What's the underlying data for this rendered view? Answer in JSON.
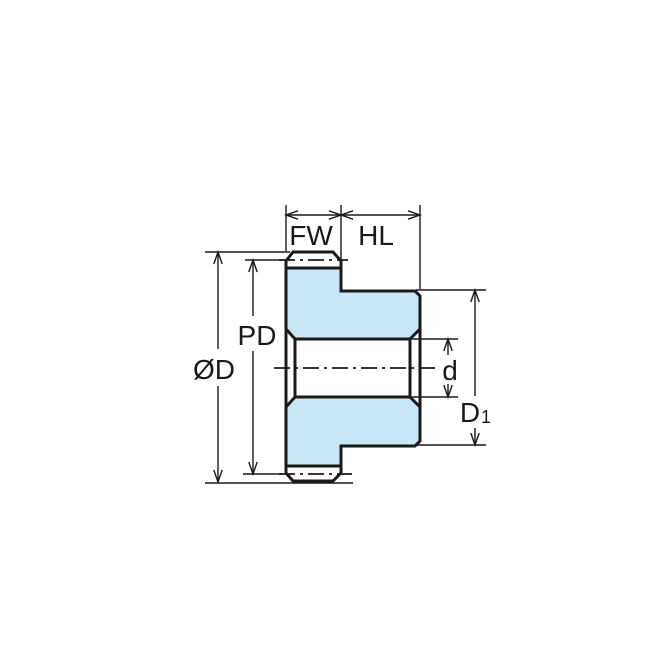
{
  "diagram": {
    "description": "Spur gear with hub - cross-section dimension drawing",
    "labels": {
      "face_width": "FW",
      "hub_length": "HL",
      "pitch_diameter": "PD",
      "outer_diameter": "ØD",
      "bore_diameter": "d",
      "hub_diameter_main": "D",
      "hub_diameter_sub": "1"
    },
    "colors": {
      "part_fill": "#c7e6f6",
      "bore_fill": "#ffffff",
      "line": "#1a1a1a",
      "background": "#ffffff"
    }
  }
}
